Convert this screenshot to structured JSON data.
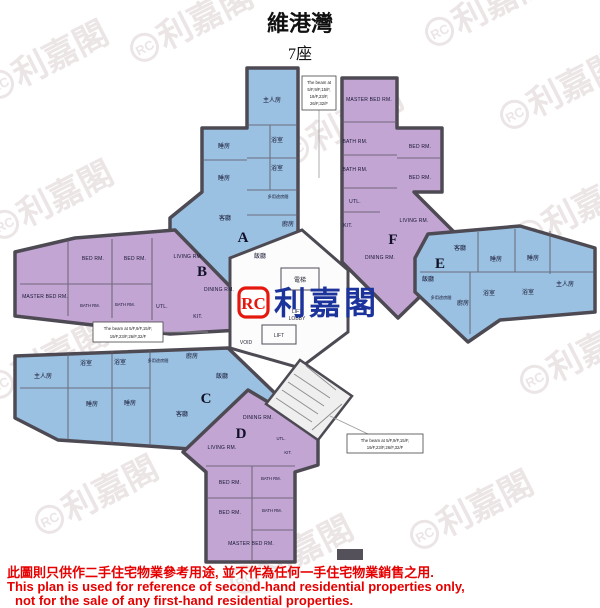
{
  "title": "維港灣",
  "subtitle": "7座",
  "watermark": {
    "rc": "RC",
    "text": "利嘉閣"
  },
  "center_logo": {
    "rc": "RC",
    "text": "利嘉閣"
  },
  "core": {
    "lift_shaft": "電梯",
    "lobby_l1": "LIFT",
    "lobby_l2": "LOBBY",
    "lift": "LIFT",
    "void": "VOID"
  },
  "beam_notes": {
    "top": [
      "The beam at",
      "5/F,9/F,15/F,",
      "19/F,23/F,",
      "26/F,32/F"
    ],
    "left": [
      "The beam at 5/F,9/F,15/F,",
      "19/F,23/F,26/F,32/F"
    ],
    "bottom": [
      "The beam at 5/F,9/F,15/F,",
      "19/F,23/F,26/F,32/F"
    ]
  },
  "units": {
    "A": {
      "id": "A",
      "rooms": {
        "master": "主人房",
        "bed1": "睡房",
        "bed2": "睡房",
        "bath1": "浴室",
        "bath2": "浴室",
        "multi": "多用途房間",
        "kitchen": "廚房",
        "living": "客廳",
        "dining": "飯廳"
      }
    },
    "B": {
      "id": "B",
      "rooms": {
        "master": "MASTER BED RM.",
        "bed1": "BED RM.",
        "bed2": "BED RM.",
        "bath1": "BATH RM.",
        "bath2": "BATH RM.",
        "utility": "UTL.",
        "kitchen": "KIT.",
        "living": "LIVING RM.",
        "dining": "DINING RM."
      }
    },
    "C": {
      "id": "C",
      "rooms": {
        "master": "主人房",
        "bed1": "睡房",
        "bed2": "睡房",
        "bath1": "浴室",
        "bath2": "浴室",
        "multi": "多用途房間",
        "kitchen": "廚房",
        "living": "客廳",
        "dining": "飯廳"
      }
    },
    "D": {
      "id": "D",
      "rooms": {
        "master": "MASTER BED RM.",
        "bed1": "BED RM.",
        "bed2": "BED RM.",
        "bath1": "BATH RM.",
        "bath2": "BATH RM.",
        "utility": "UTL.",
        "kitchen": "KIT.",
        "living": "LIVING RM.",
        "dining": "DINING RM."
      }
    },
    "E": {
      "id": "E",
      "rooms": {
        "master": "主人房",
        "bed1": "睡房",
        "bed2": "睡房",
        "bath1": "浴室",
        "bath2": "浴室",
        "multi": "多用途房間",
        "kitchen": "廚房",
        "living": "客廳",
        "dining": "飯廳"
      }
    },
    "F": {
      "id": "F",
      "rooms": {
        "master": "MASTER BED RM.",
        "bed1": "BATH RM.",
        "bed2": "BED RM.",
        "bath1": "BATH RM.",
        "bath2": "BED RM.",
        "utility": "UTL.",
        "kitchen": "KIT.",
        "living": "LIVING RM.",
        "dining": "DINING RM."
      }
    }
  },
  "disclaimer": {
    "line1": "此圖則只供作二手住宅物業參考用途, 並不作為任何一手住宅物業銷售之用.",
    "line2": "This plan is used for reference of second-hand residential properties only,",
    "line3": "not for the sale of any first-hand residential properties."
  },
  "colors": {
    "unit_blue": "#9bc1e2",
    "unit_purple": "#c2a5d3",
    "wall": "#4e4a54",
    "logo_red": "#e5180f",
    "logo_blue": "#1c339b",
    "disclaimer_red": "#e60000"
  }
}
